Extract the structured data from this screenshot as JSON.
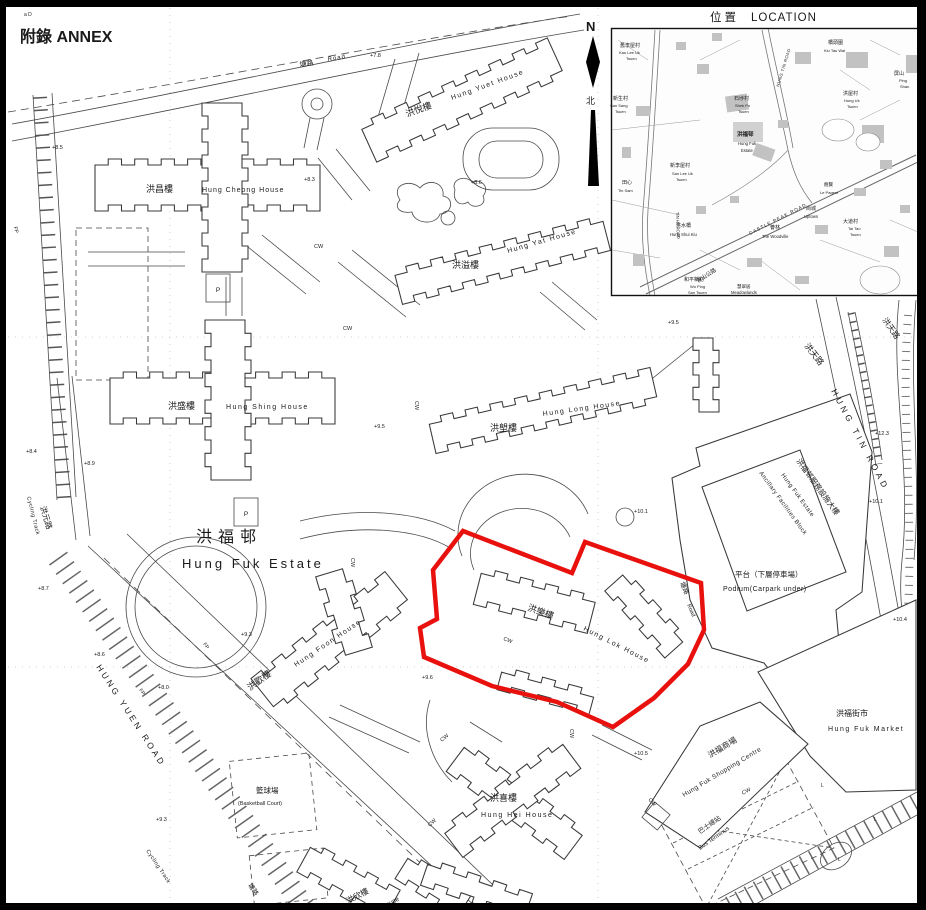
{
  "page": {
    "annex_label": "附錄 ANNEX",
    "corner_note": "a  D"
  },
  "north_arrow": {
    "n": "N",
    "zh": "北"
  },
  "inset": {
    "title_zh": "位置",
    "title_en": "LOCATION"
  },
  "site": {
    "boundary_color": "#e8110e"
  },
  "map_labels": [
    {
      "t": "塘路",
      "x": 300,
      "y": 67,
      "r": -9,
      "s": 7,
      "n": "road-tong-lo-zh"
    },
    {
      "t": "Road",
      "x": 328,
      "y": 61,
      "r": -9,
      "s": 6,
      "ls": 1,
      "n": "road-tong-lo-en"
    },
    {
      "t": "洪悅樓",
      "x": 407,
      "y": 117,
      "r": -20,
      "s": 9,
      "n": "bldg-hung-yuet-house-zh"
    },
    {
      "t": "Hung Yuet House",
      "x": 452,
      "y": 100,
      "r": -20,
      "s": 7,
      "ls": 1.5,
      "n": "bldg-hung-yuet-house-en"
    },
    {
      "t": "洪昌樓",
      "x": 146,
      "y": 192,
      "s": 9,
      "n": "bldg-hung-cheong-house-zh"
    },
    {
      "t": "Hung Cheong House",
      "x": 202,
      "y": 192,
      "s": 7,
      "ls": 1,
      "n": "bldg-hung-cheong-house-en"
    },
    {
      "t": "洪溢樓",
      "x": 452,
      "y": 268,
      "s": 9,
      "n": "bldg-hung-yat-house-zh"
    },
    {
      "t": "Hung Yat House",
      "x": 508,
      "y": 253,
      "r": -16,
      "s": 7,
      "ls": 1.5,
      "n": "bldg-hung-yat-house-en"
    },
    {
      "t": "洪盛樓",
      "x": 168,
      "y": 409,
      "s": 9,
      "n": "bldg-hung-shing-house-zh"
    },
    {
      "t": "Hung Shing House",
      "x": 226,
      "y": 409,
      "s": 7,
      "ls": 1.5,
      "n": "bldg-hung-shing-house-en"
    },
    {
      "t": "洪塱樓",
      "x": 490,
      "y": 431,
      "s": 9,
      "n": "bldg-hung-long-house-zh"
    },
    {
      "t": "Hung Long House",
      "x": 543,
      "y": 416,
      "r": -8,
      "s": 7,
      "ls": 1.5,
      "n": "bldg-hung-long-house-en"
    },
    {
      "t": "洪福邨",
      "x": 196,
      "y": 542,
      "s": 16,
      "ls": 6,
      "c": "#222",
      "n": "estate-name-zh"
    },
    {
      "t": "Hung Fuk Estate",
      "x": 182,
      "y": 568,
      "s": 13,
      "ls": 3,
      "c": "#222",
      "n": "estate-name-en"
    },
    {
      "t": "洪樂樓",
      "x": 527,
      "y": 610,
      "r": 20,
      "s": 9,
      "n": "bldg-hung-lok-house-zh"
    },
    {
      "t": "Hung Lok House",
      "x": 583,
      "y": 630,
      "r": 27,
      "s": 7,
      "ls": 1.5,
      "n": "bldg-hung-lok-house-en"
    },
    {
      "t": "洪歡樓",
      "x": 250,
      "y": 691,
      "r": -36,
      "s": 9,
      "n": "bldg-hung-foon-house-zh"
    },
    {
      "t": "Hung Foon House",
      "x": 296,
      "y": 667,
      "r": -34,
      "s": 7,
      "ls": 1.5,
      "n": "bldg-hung-foon-house-en"
    },
    {
      "t": "洪喜樓",
      "x": 490,
      "y": 801,
      "s": 9,
      "n": "bldg-hung-hei-house-zh"
    },
    {
      "t": "Hung Hei House",
      "x": 481,
      "y": 817,
      "s": 7,
      "ls": 1.5,
      "n": "bldg-hung-hei-house-en"
    },
    {
      "t": "洪欣樓",
      "x": 348,
      "y": 904,
      "r": -28,
      "s": 8,
      "n": "bldg-hung-yan-house-zh"
    },
    {
      "t": "House",
      "x": 383,
      "y": 909,
      "r": -28,
      "s": 6.5,
      "n": "bldg-hung-yan-house-en"
    },
    {
      "t": "籃球場",
      "x": 256,
      "y": 793,
      "s": 7.5,
      "n": "basketball-court-zh"
    },
    {
      "t": "(Basketball Court)",
      "x": 238,
      "y": 805,
      "s": 5.5,
      "n": "basketball-court-en"
    },
    {
      "t": "洪福邨服務設施大樓",
      "x": 796,
      "y": 461,
      "r": 54,
      "s": 7.5,
      "n": "ancillary-block-zh"
    },
    {
      "t": "Hung Fuk Estate",
      "x": 781,
      "y": 475,
      "r": 54,
      "s": 6,
      "ls": 0.5,
      "n": "ancillary-block-en1"
    },
    {
      "t": "Ancillary Facilities Block",
      "x": 759,
      "y": 473,
      "r": 54,
      "s": 6,
      "ls": 0.5,
      "n": "ancillary-block-en2"
    },
    {
      "t": "平台（下層停車場）",
      "x": 735,
      "y": 577,
      "s": 7.5,
      "n": "podium-zh"
    },
    {
      "t": "Podium(Carpark under)",
      "x": 723,
      "y": 591,
      "s": 7,
      "ls": 0.5,
      "n": "podium-en"
    },
    {
      "t": "洪福街市",
      "x": 836,
      "y": 716,
      "s": 8,
      "n": "market-zh"
    },
    {
      "t": "Hung Fuk Market",
      "x": 828,
      "y": 731,
      "s": 7,
      "ls": 1.5,
      "n": "market-en"
    },
    {
      "t": "洪福商場",
      "x": 710,
      "y": 758,
      "r": -31,
      "s": 8,
      "n": "shopping-centre-zh"
    },
    {
      "t": "Hung Fuk Shopping Centre",
      "x": 684,
      "y": 797,
      "r": -31,
      "s": 6.5,
      "ls": 0.5,
      "n": "shopping-centre-en"
    },
    {
      "t": "巴士總站",
      "x": 700,
      "y": 834,
      "r": -35,
      "s": 6.5,
      "n": "bus-terminus-zh"
    },
    {
      "t": "Bus Terminus",
      "x": 700,
      "y": 850,
      "r": -35,
      "s": 6,
      "n": "bus-terminus-en"
    },
    {
      "t": "HUNG YUEN ROAD",
      "x": 96,
      "y": 667,
      "r": 57,
      "s": 8.5,
      "ls": 3,
      "n": "road-hung-yuen-road"
    },
    {
      "t": "Cycling Track",
      "x": 27,
      "y": 497,
      "r": 76,
      "s": 5.5,
      "ls": 0.5,
      "c": "#333",
      "n": "cycling-track-label"
    },
    {
      "t": "Cycling Track",
      "x": 146,
      "y": 851,
      "r": 56,
      "s": 5.5,
      "ls": 0.5,
      "c": "#333",
      "n": "cycling-track-label"
    },
    {
      "t": "洪元路",
      "x": 40,
      "y": 507,
      "r": 73,
      "s": 8,
      "n": "road-hung-yuen-lo-zh"
    },
    {
      "t": "洪天路",
      "x": 804,
      "y": 346,
      "r": 52,
      "s": 8.5,
      "n": "road-hung-tin-lo-zh"
    },
    {
      "t": "HUNG TIN ROAD",
      "x": 831,
      "y": 391,
      "r": 62,
      "s": 8.5,
      "ls": 3.5,
      "n": "road-hung-tin-road"
    },
    {
      "t": "洪天路",
      "x": 882,
      "y": 320,
      "r": 55,
      "s": 8,
      "n": "road-hung-tin-lo-zh"
    },
    {
      "t": "塘路",
      "x": 680,
      "y": 583,
      "r": 66,
      "s": 6.5,
      "n": "road-tong-lo-zh"
    },
    {
      "t": "Road",
      "x": 687,
      "y": 605,
      "r": 66,
      "s": 5.5,
      "n": "road-tong-lo-en"
    },
    {
      "t": "塘路",
      "x": 248,
      "y": 885,
      "r": 58,
      "s": 6.5,
      "n": "road-tong-lo-zh"
    },
    {
      "t": "Road",
      "x": 256,
      "y": 905,
      "r": 58,
      "s": 5.5,
      "n": "road-tong-lo-en"
    },
    {
      "t": "a  D",
      "x": 24,
      "y": 16,
      "s": 5,
      "c": "#444",
      "n": "corner-note"
    },
    {
      "t": "+7.8",
      "x": 370,
      "y": 57,
      "s": 5.5,
      "c": "#333",
      "n": "spot-height"
    },
    {
      "t": "+8.5",
      "x": 52,
      "y": 149,
      "s": 5.5,
      "c": "#333",
      "n": "spot-height"
    },
    {
      "t": "+8.3",
      "x": 304,
      "y": 181,
      "s": 5.5,
      "c": "#333",
      "n": "spot-height"
    },
    {
      "t": "+8.6",
      "x": 471,
      "y": 184,
      "s": 5.5,
      "c": "#333",
      "n": "spot-height"
    },
    {
      "t": "+9.5",
      "x": 668,
      "y": 324,
      "s": 5.5,
      "c": "#333",
      "n": "spot-height"
    },
    {
      "t": "+8.4",
      "x": 26,
      "y": 453,
      "s": 5.5,
      "c": "#333",
      "n": "spot-height"
    },
    {
      "t": "+8.9",
      "x": 84,
      "y": 465,
      "s": 5.5,
      "c": "#333",
      "n": "spot-height"
    },
    {
      "t": "+8.7",
      "x": 38,
      "y": 590,
      "s": 5.5,
      "c": "#333",
      "n": "spot-height"
    },
    {
      "t": "+8.6",
      "x": 94,
      "y": 656,
      "s": 5.5,
      "c": "#333",
      "n": "spot-height"
    },
    {
      "t": "+8.0",
      "x": 158,
      "y": 689,
      "s": 5.5,
      "c": "#333",
      "n": "spot-height"
    },
    {
      "t": "+9.3",
      "x": 241,
      "y": 636,
      "s": 5.5,
      "c": "#333",
      "n": "spot-height"
    },
    {
      "t": "+9.3",
      "x": 156,
      "y": 821,
      "s": 5.5,
      "c": "#333",
      "n": "spot-height"
    },
    {
      "t": "+9.6",
      "x": 422,
      "y": 679,
      "s": 5.5,
      "c": "#333",
      "n": "spot-height"
    },
    {
      "t": "+9.5",
      "x": 374,
      "y": 428,
      "s": 5.5,
      "c": "#333",
      "n": "spot-height"
    },
    {
      "t": "+10.1",
      "x": 634,
      "y": 513,
      "s": 5.5,
      "c": "#333",
      "n": "spot-height"
    },
    {
      "t": "+10.1",
      "x": 869,
      "y": 503,
      "s": 5.5,
      "c": "#333",
      "n": "spot-height"
    },
    {
      "t": "+10.4",
      "x": 893,
      "y": 621,
      "s": 5.5,
      "c": "#333",
      "n": "spot-height"
    },
    {
      "t": "+12.3",
      "x": 875,
      "y": 435,
      "s": 5.5,
      "c": "#333",
      "n": "spot-height"
    },
    {
      "t": "+10.5",
      "x": 634,
      "y": 755,
      "s": 5.5,
      "c": "#333",
      "n": "spot-height"
    },
    {
      "t": "CW",
      "x": 314,
      "y": 248,
      "s": 5.5,
      "c": "#333",
      "n": "cw-label"
    },
    {
      "t": "CW",
      "x": 343,
      "y": 330,
      "s": 5.5,
      "c": "#333",
      "n": "cw-label"
    },
    {
      "t": "CW",
      "x": 415,
      "y": 401,
      "r": 90,
      "s": 5.5,
      "c": "#333",
      "n": "cw-label"
    },
    {
      "t": "CW",
      "x": 351,
      "y": 558,
      "r": 90,
      "s": 5.5,
      "c": "#333",
      "n": "cw-label"
    },
    {
      "t": "CW",
      "x": 503,
      "y": 640,
      "r": 22,
      "s": 5.5,
      "c": "#333",
      "n": "cw-label"
    },
    {
      "t": "CW",
      "x": 570,
      "y": 729,
      "r": 90,
      "s": 5.5,
      "c": "#333",
      "n": "cw-label"
    },
    {
      "t": "CW",
      "x": 442,
      "y": 742,
      "r": -40,
      "s": 5.5,
      "c": "#333",
      "n": "cw-label"
    },
    {
      "t": "CW",
      "x": 430,
      "y": 827,
      "r": -45,
      "s": 5.5,
      "c": "#333",
      "n": "cw-label"
    },
    {
      "t": "CW",
      "x": 648,
      "y": 800,
      "r": 45,
      "s": 5.5,
      "c": "#333",
      "n": "cw-label"
    },
    {
      "t": "CW",
      "x": 743,
      "y": 795,
      "r": -30,
      "s": 5.5,
      "c": "#333",
      "n": "cw-label"
    },
    {
      "t": "FP",
      "x": 14,
      "y": 227,
      "r": 78,
      "s": 5,
      "c": "#333",
      "n": "fp-label"
    },
    {
      "t": "FP",
      "x": 139,
      "y": 690,
      "r": 56,
      "s": 5,
      "c": "#333",
      "n": "fp-label"
    },
    {
      "t": "FP",
      "x": 203,
      "y": 644,
      "r": 56,
      "s": 5,
      "c": "#333",
      "n": "fp-label"
    },
    {
      "t": "L",
      "x": 821,
      "y": 787,
      "s": 5,
      "c": "#333",
      "n": "lamp-label"
    },
    {
      "t": "L",
      "x": 874,
      "y": 821,
      "s": 5,
      "c": "#333",
      "n": "lamp-label"
    },
    {
      "t": "L",
      "x": 838,
      "y": 861,
      "s": 5,
      "c": "#333",
      "n": "lamp-label"
    },
    {
      "t": "P",
      "x": 218,
      "y": 292,
      "s": 6.5,
      "a": "middle",
      "c": "#222",
      "n": "parking-label"
    },
    {
      "t": "P",
      "x": 246,
      "y": 516,
      "s": 6.5,
      "a": "middle",
      "c": "#222",
      "n": "parking-label"
    }
  ],
  "inset_labels": [
    {
      "t": "舊李屋村",
      "x": 620,
      "y": 47,
      "s": 5,
      "c": "#333",
      "n": "inset-kau-lee-uk-tsuen-zh"
    },
    {
      "t": "Kau Lee Uk",
      "x": 619,
      "y": 54,
      "s": 4,
      "c": "#333",
      "n": "inset-kau-lee-uk-tsuen-en"
    },
    {
      "t": "Tsuen",
      "x": 626,
      "y": 60,
      "s": 4,
      "c": "#333",
      "n": "inset-kau-lee-uk-tsuen-en"
    },
    {
      "t": "橋頭圍",
      "x": 828,
      "y": 44,
      "s": 5,
      "c": "#333",
      "n": "inset-kiu-tau-wai-zh"
    },
    {
      "t": "Kiu Tau Wai",
      "x": 824,
      "y": 52,
      "s": 4,
      "c": "#333",
      "n": "inset-kiu-tau-wai-en"
    },
    {
      "t": "屏山",
      "x": 894,
      "y": 75,
      "s": 5,
      "c": "#333",
      "n": "inset-ping-shan-zh"
    },
    {
      "t": "Ping",
      "x": 899,
      "y": 82,
      "s": 4,
      "c": "#333",
      "n": "inset-ping-shan-en"
    },
    {
      "t": "Shan",
      "x": 900,
      "y": 88,
      "s": 4,
      "c": "#333",
      "n": "inset-ping-shan-en"
    },
    {
      "t": "新生村",
      "x": 613,
      "y": 100,
      "s": 5,
      "c": "#333",
      "n": "inset-san-sang-tsuen-zh"
    },
    {
      "t": "San Sang",
      "x": 610,
      "y": 107,
      "s": 4,
      "c": "#333",
      "n": "inset-san-sang-tsuen-en"
    },
    {
      "t": "Tsuen",
      "x": 615,
      "y": 113,
      "s": 4,
      "c": "#333",
      "n": "inset-san-sang-tsuen-en"
    },
    {
      "t": "石埗村",
      "x": 734,
      "y": 100,
      "s": 5,
      "c": "#333",
      "n": "inset-shek-po-tsuen-zh"
    },
    {
      "t": "Shek Po",
      "x": 735,
      "y": 107,
      "s": 4,
      "c": "#333",
      "n": "inset-shek-po-tsuen-en"
    },
    {
      "t": "Tsuen",
      "x": 738,
      "y": 113,
      "s": 4,
      "c": "#333",
      "n": "inset-shek-po-tsuen-en"
    },
    {
      "t": "洪屋村",
      "x": 843,
      "y": 95,
      "s": 5,
      "c": "#333",
      "n": "inset-hung-uk-tsuen-zh"
    },
    {
      "t": "Hung Uk",
      "x": 844,
      "y": 102,
      "s": 4,
      "c": "#333",
      "n": "inset-hung-uk-tsuen-en"
    },
    {
      "t": "Tsuen",
      "x": 847,
      "y": 108,
      "s": 4,
      "c": "#333",
      "n": "inset-hung-uk-tsuen-en"
    },
    {
      "t": "洪福邨",
      "x": 737,
      "y": 136,
      "s": 5.5,
      "b": true,
      "c": "#111",
      "n": "inset-hung-fuk-estate-zh"
    },
    {
      "t": "Hung Fuk",
      "x": 738,
      "y": 145,
      "s": 4.2,
      "c": "#333",
      "n": "inset-hung-fuk-estate-en"
    },
    {
      "t": "Estate",
      "x": 741,
      "y": 152,
      "s": 4.2,
      "c": "#333",
      "n": "inset-hung-fuk-estate-en"
    },
    {
      "t": "新李屋村",
      "x": 670,
      "y": 167,
      "s": 5,
      "c": "#333",
      "n": "inset-san-lee-uk-tsuen-zh"
    },
    {
      "t": "San Lee Uk",
      "x": 672,
      "y": 175,
      "s": 4,
      "c": "#333",
      "n": "inset-san-lee-uk-tsuen-en"
    },
    {
      "t": "Tsuen",
      "x": 676,
      "y": 181,
      "s": 4,
      "c": "#333",
      "n": "inset-san-lee-uk-tsuen-en"
    },
    {
      "t": "田心",
      "x": 622,
      "y": 184,
      "s": 5,
      "c": "#333",
      "n": "inset-tin-sam-zh"
    },
    {
      "t": "Tin Sam",
      "x": 618,
      "y": 192,
      "s": 4,
      "c": "#333",
      "n": "inset-tin-sam-en"
    },
    {
      "t": "翹賢",
      "x": 824,
      "y": 186,
      "s": 4.5,
      "c": "#333",
      "n": "inset-development-zh"
    },
    {
      "t": "Le Pagent",
      "x": 820,
      "y": 194,
      "s": 4,
      "c": "#333",
      "n": "inset-development-en"
    },
    {
      "t": "尚城",
      "x": 806,
      "y": 210,
      "s": 5,
      "c": "#333",
      "n": "inset-uptown-zh"
    },
    {
      "t": "Uptown",
      "x": 804,
      "y": 218,
      "s": 4.2,
      "c": "#333",
      "n": "inset-uptown-en"
    },
    {
      "t": "大道村",
      "x": 843,
      "y": 223,
      "s": 5,
      "c": "#333",
      "n": "inset-tai-tao-tsuen-zh"
    },
    {
      "t": "Tai Tao",
      "x": 848,
      "y": 230,
      "s": 4,
      "c": "#333",
      "n": "inset-tai-tao-tsuen-en"
    },
    {
      "t": "Tsuen",
      "x": 850,
      "y": 236,
      "s": 4,
      "c": "#333",
      "n": "inset-tai-tao-tsuen-en"
    },
    {
      "t": "薈林",
      "x": 770,
      "y": 229,
      "s": 5,
      "c": "#333",
      "n": "inset-woodville-zh"
    },
    {
      "t": "The Woodville",
      "x": 762,
      "y": 238,
      "s": 4.2,
      "c": "#333",
      "n": "inset-woodville-en"
    },
    {
      "t": "洪水橋",
      "x": 676,
      "y": 227,
      "s": 5,
      "c": "#333",
      "n": "inset-hung-shui-kiu-zh"
    },
    {
      "t": "Hung Shui Kiu",
      "x": 670,
      "y": 236,
      "s": 4.2,
      "c": "#333",
      "n": "inset-hung-shui-kiu-en"
    },
    {
      "t": "和平新村",
      "x": 684,
      "y": 281,
      "s": 5,
      "c": "#333",
      "n": "inset-wo-ping-san-tsuen-zh"
    },
    {
      "t": "Wo Ping",
      "x": 690,
      "y": 288,
      "s": 4,
      "c": "#333",
      "n": "inset-wo-ping-san-tsuen-en"
    },
    {
      "t": "San Tsuen",
      "x": 688,
      "y": 294,
      "s": 4,
      "c": "#333",
      "n": "inset-wo-ping-san-tsuen-en"
    },
    {
      "t": "慧翠居",
      "x": 737,
      "y": 288,
      "s": 4.5,
      "c": "#333",
      "n": "inset-meadowlands-zh"
    },
    {
      "t": "Meadowlands",
      "x": 731,
      "y": 294,
      "s": 4.2,
      "c": "#333",
      "n": "inset-meadowlands-en"
    },
    {
      "t": "CASTLE PEAK ROAD",
      "x": 750,
      "y": 235,
      "r": -27,
      "s": 4.8,
      "ls": 1,
      "c": "#333",
      "n": "inset-castle-peak-road-en"
    },
    {
      "t": "青山公路",
      "x": 698,
      "y": 283,
      "r": -33,
      "s": 5.5,
      "c": "#333",
      "n": "inset-castle-peak-road-zh"
    },
    {
      "t": "TIN HA ROAD",
      "x": 676,
      "y": 212,
      "r": 88,
      "s": 4.2,
      "c": "#333",
      "n": "inset-tin-ha-road"
    },
    {
      "t": "HUNG TIN ROAD",
      "x": 779,
      "y": 87,
      "r": -73,
      "s": 4.2,
      "ls": 0.5,
      "c": "#333",
      "n": "inset-hung-tin-road"
    }
  ]
}
